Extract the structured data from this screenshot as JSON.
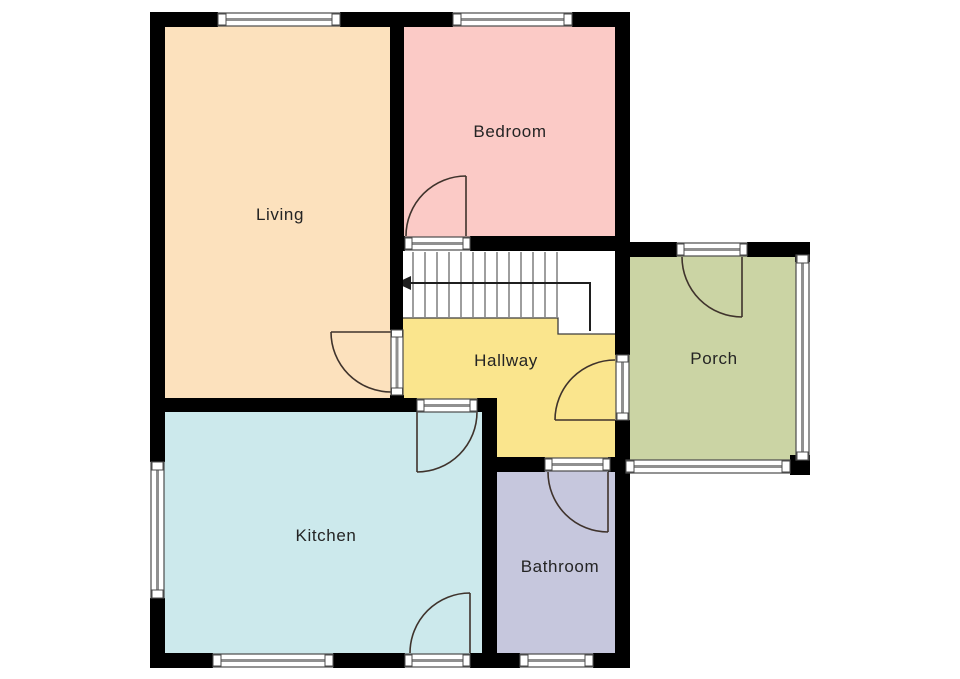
{
  "floorplan": {
    "type": "residential-floor-plan",
    "background_color": "#ffffff",
    "wall_color": "#000000",
    "rooms": [
      {
        "id": "living",
        "label": "Living",
        "color": "#fce1bd"
      },
      {
        "id": "bedroom",
        "label": "Bedroom",
        "color": "#fbcac6"
      },
      {
        "id": "hallway",
        "label": "Hallway",
        "color": "#fae58d"
      },
      {
        "id": "porch",
        "label": "Porch",
        "color": "#cbd4a4"
      },
      {
        "id": "kitchen",
        "label": "Kitchen",
        "color": "#cce9ec"
      },
      {
        "id": "bathroom",
        "label": "Bathroom",
        "color": "#c6c7dd"
      }
    ],
    "stairs": {
      "fill": "#ffffff",
      "arrow_direction": "left"
    }
  }
}
